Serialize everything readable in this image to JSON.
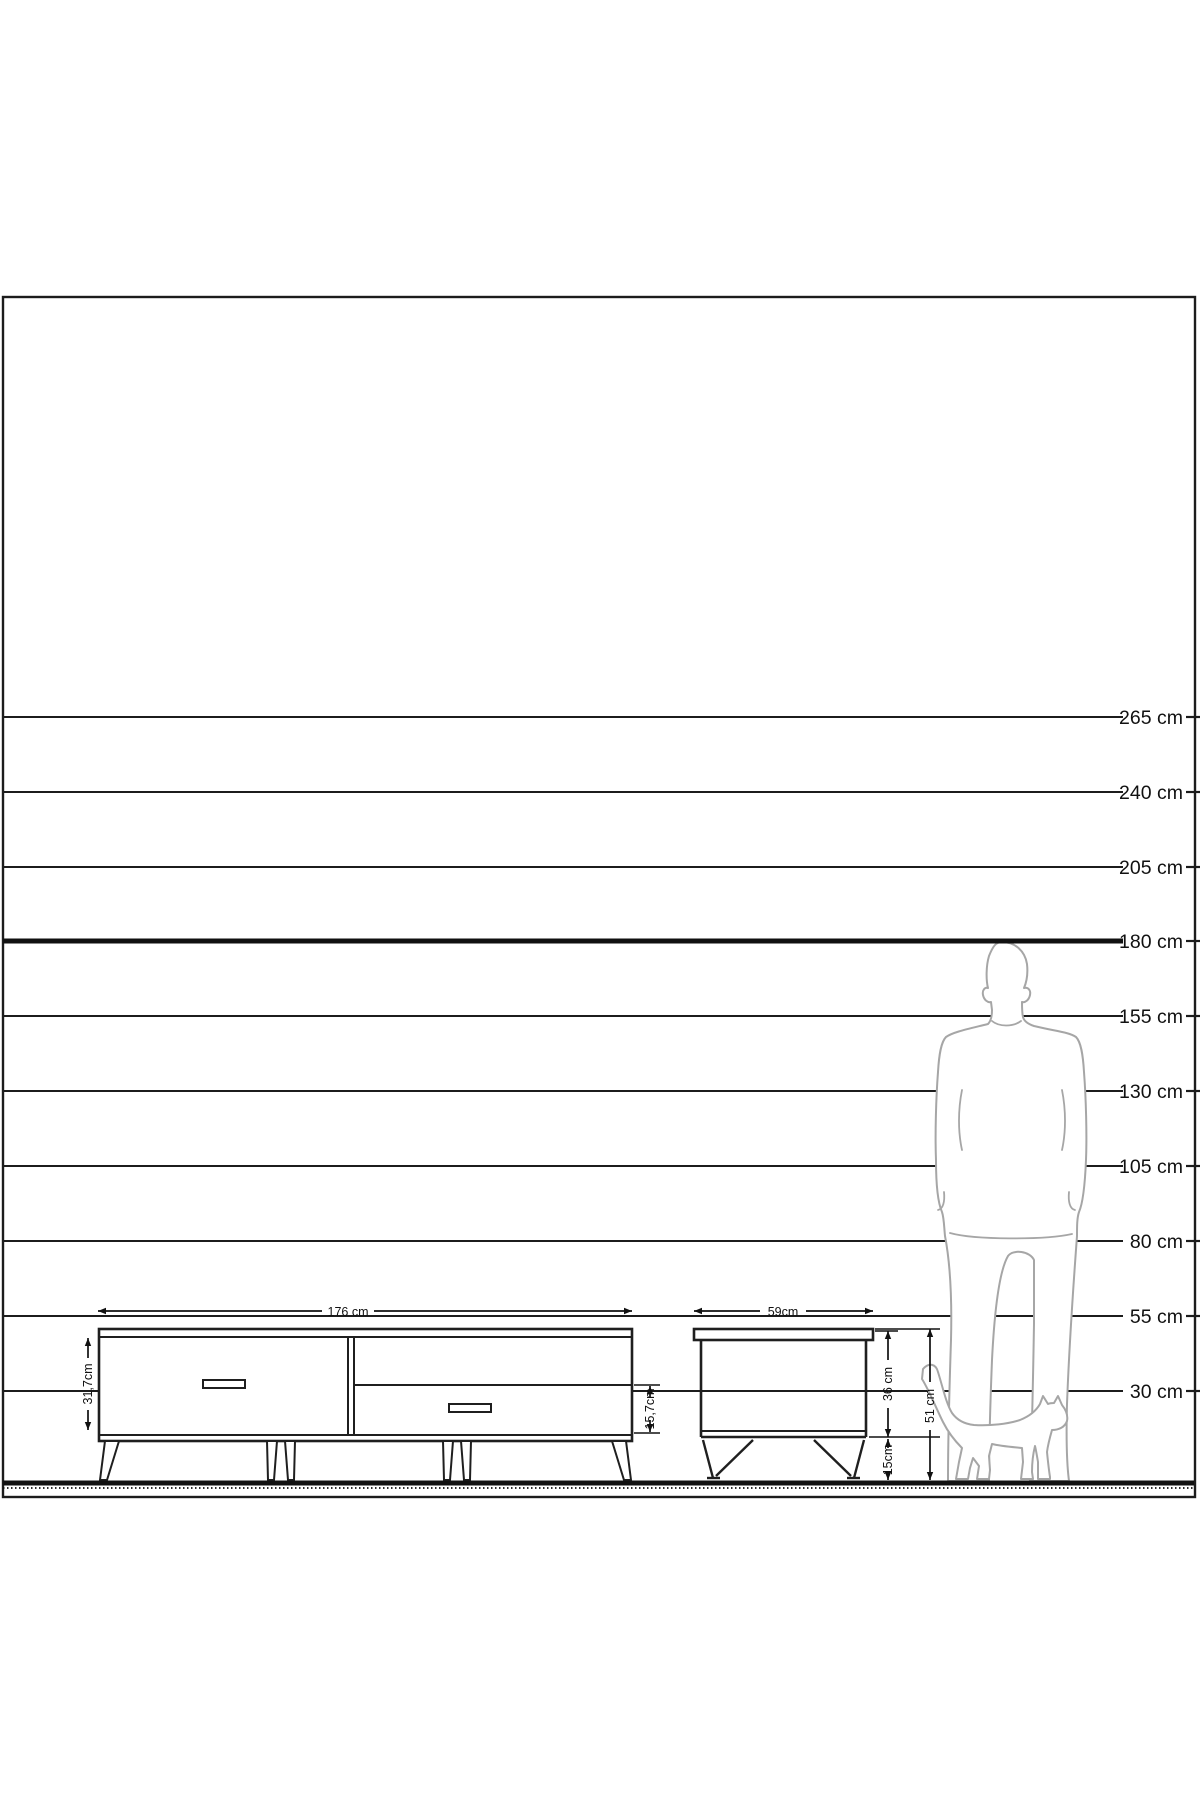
{
  "scale": {
    "unit": "cm",
    "lines": [
      {
        "label": "265 cm",
        "value": 265
      },
      {
        "label": "240 cm",
        "value": 240
      },
      {
        "label": "205 cm",
        "value": 205
      },
      {
        "label": "180 cm",
        "value": 180,
        "bold": true
      },
      {
        "label": "155 cm",
        "value": 155
      },
      {
        "label": "130 cm",
        "value": 130
      },
      {
        "label": "105 cm",
        "value": 105
      },
      {
        "label": "80 cm",
        "value": 80
      },
      {
        "label": "55 cm",
        "value": 55
      },
      {
        "label": "30 cm",
        "value": 30
      }
    ]
  },
  "tv_stand": {
    "width_label": "176 cm",
    "front_height_label": "31,7cm",
    "drawer_height_label": "15,7cm"
  },
  "side_table": {
    "width_label": "59cm",
    "body_height_label": "36 cm",
    "leg_height_label": "15cm",
    "total_height_label": "51 cm"
  },
  "reference_figures": {
    "man_aligned_line_cm": 180,
    "man": "standing man silhouette",
    "cat": "walking cat silhouette"
  },
  "colors": {
    "line": "#1c1c1c",
    "silhouette_outline": "#a6a6a6",
    "background": "#ffffff"
  }
}
